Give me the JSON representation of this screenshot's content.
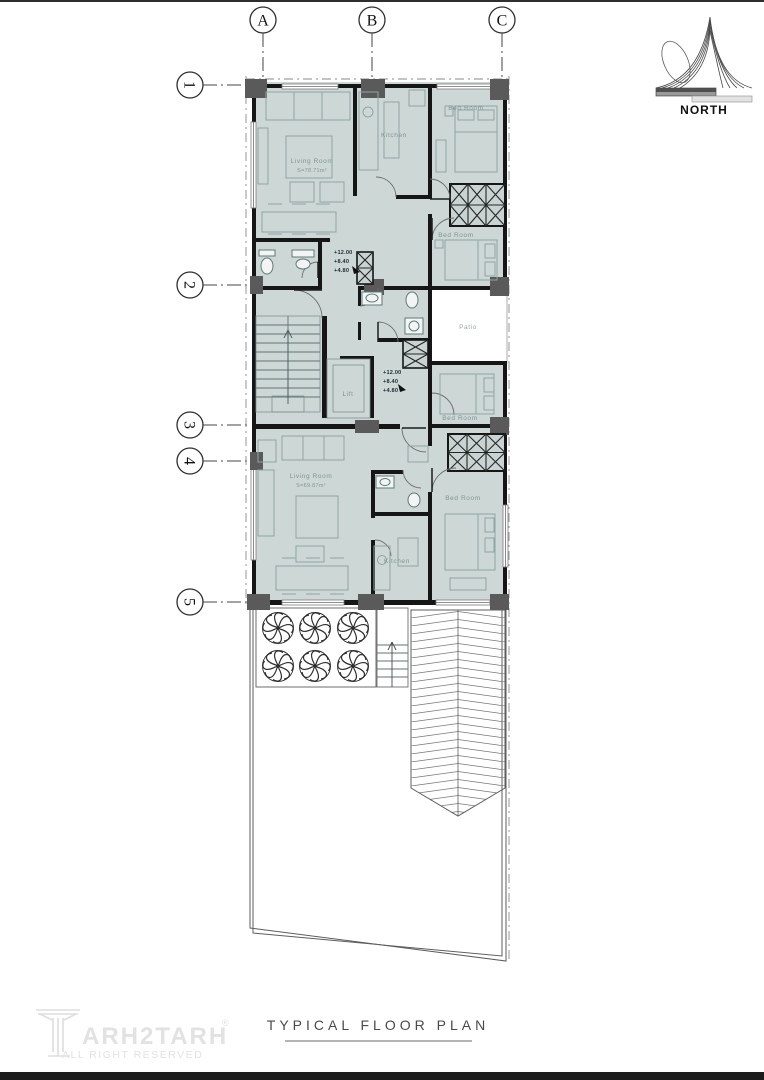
{
  "page": {
    "title": "TYPICAL  FLOOR  PLAN"
  },
  "north": {
    "label": "NORTH"
  },
  "grid": {
    "cols": [
      {
        "label": "A"
      },
      {
        "label": "B"
      },
      {
        "label": "C"
      }
    ],
    "rows": [
      {
        "label": "1"
      },
      {
        "label": "2"
      },
      {
        "label": "3"
      },
      {
        "label": "4"
      },
      {
        "label": "5"
      }
    ]
  },
  "units": {
    "upper": {
      "living": {
        "name": "Living Room",
        "area": "S=78.71m²"
      },
      "kitchen": "Kitchen",
      "bed1": "Bed Room",
      "bed2": "Bed Room"
    },
    "lower": {
      "living": {
        "name": "Living Room",
        "area": "S=69.87m²"
      },
      "kitchen": "Kitchen",
      "bed1": "Bed Room",
      "bed2": "Bed Room"
    }
  },
  "core": {
    "patio": "Patio",
    "lift": "Lift",
    "levels": [
      "+12.00",
      "+8.40",
      "+4.80"
    ]
  },
  "logo": {
    "brand": "ARH2TARH",
    "reg": "®",
    "tagline": "ALL RIGHT RESERVED"
  },
  "colors": {
    "plan-fill": "#cdd8d6",
    "patio-bg": "#ffffff",
    "wall": "#161616",
    "column": "#5a5a5a",
    "furniture": "#8fa5a3",
    "room-label": "#7f9593",
    "logo": "#e2e2e2",
    "frame": "#1c1c1c"
  }
}
